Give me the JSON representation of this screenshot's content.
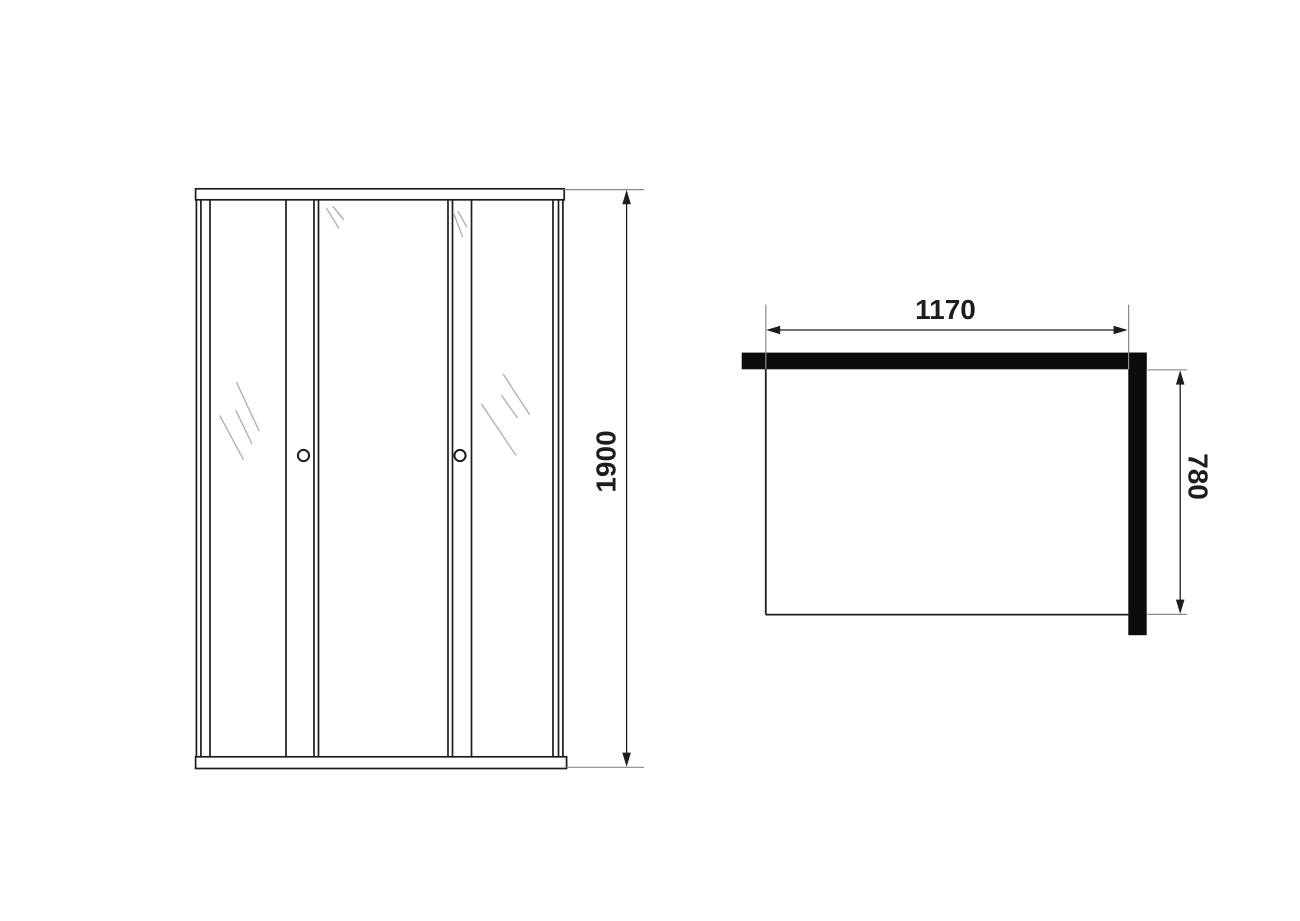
{
  "colors": {
    "background": "#ffffff",
    "frame_line": "#1d1d1b",
    "glass_shine": "#b2b2b2",
    "wall_profile_fill": "#0c0c0c",
    "dimension_line": "#1d1d1b",
    "extension_line": "#8a8a8a"
  },
  "front_view": {
    "height_dimension_label": "1900"
  },
  "plan_view": {
    "width_dimension_label": "1170",
    "depth_dimension_label": "780"
  }
}
